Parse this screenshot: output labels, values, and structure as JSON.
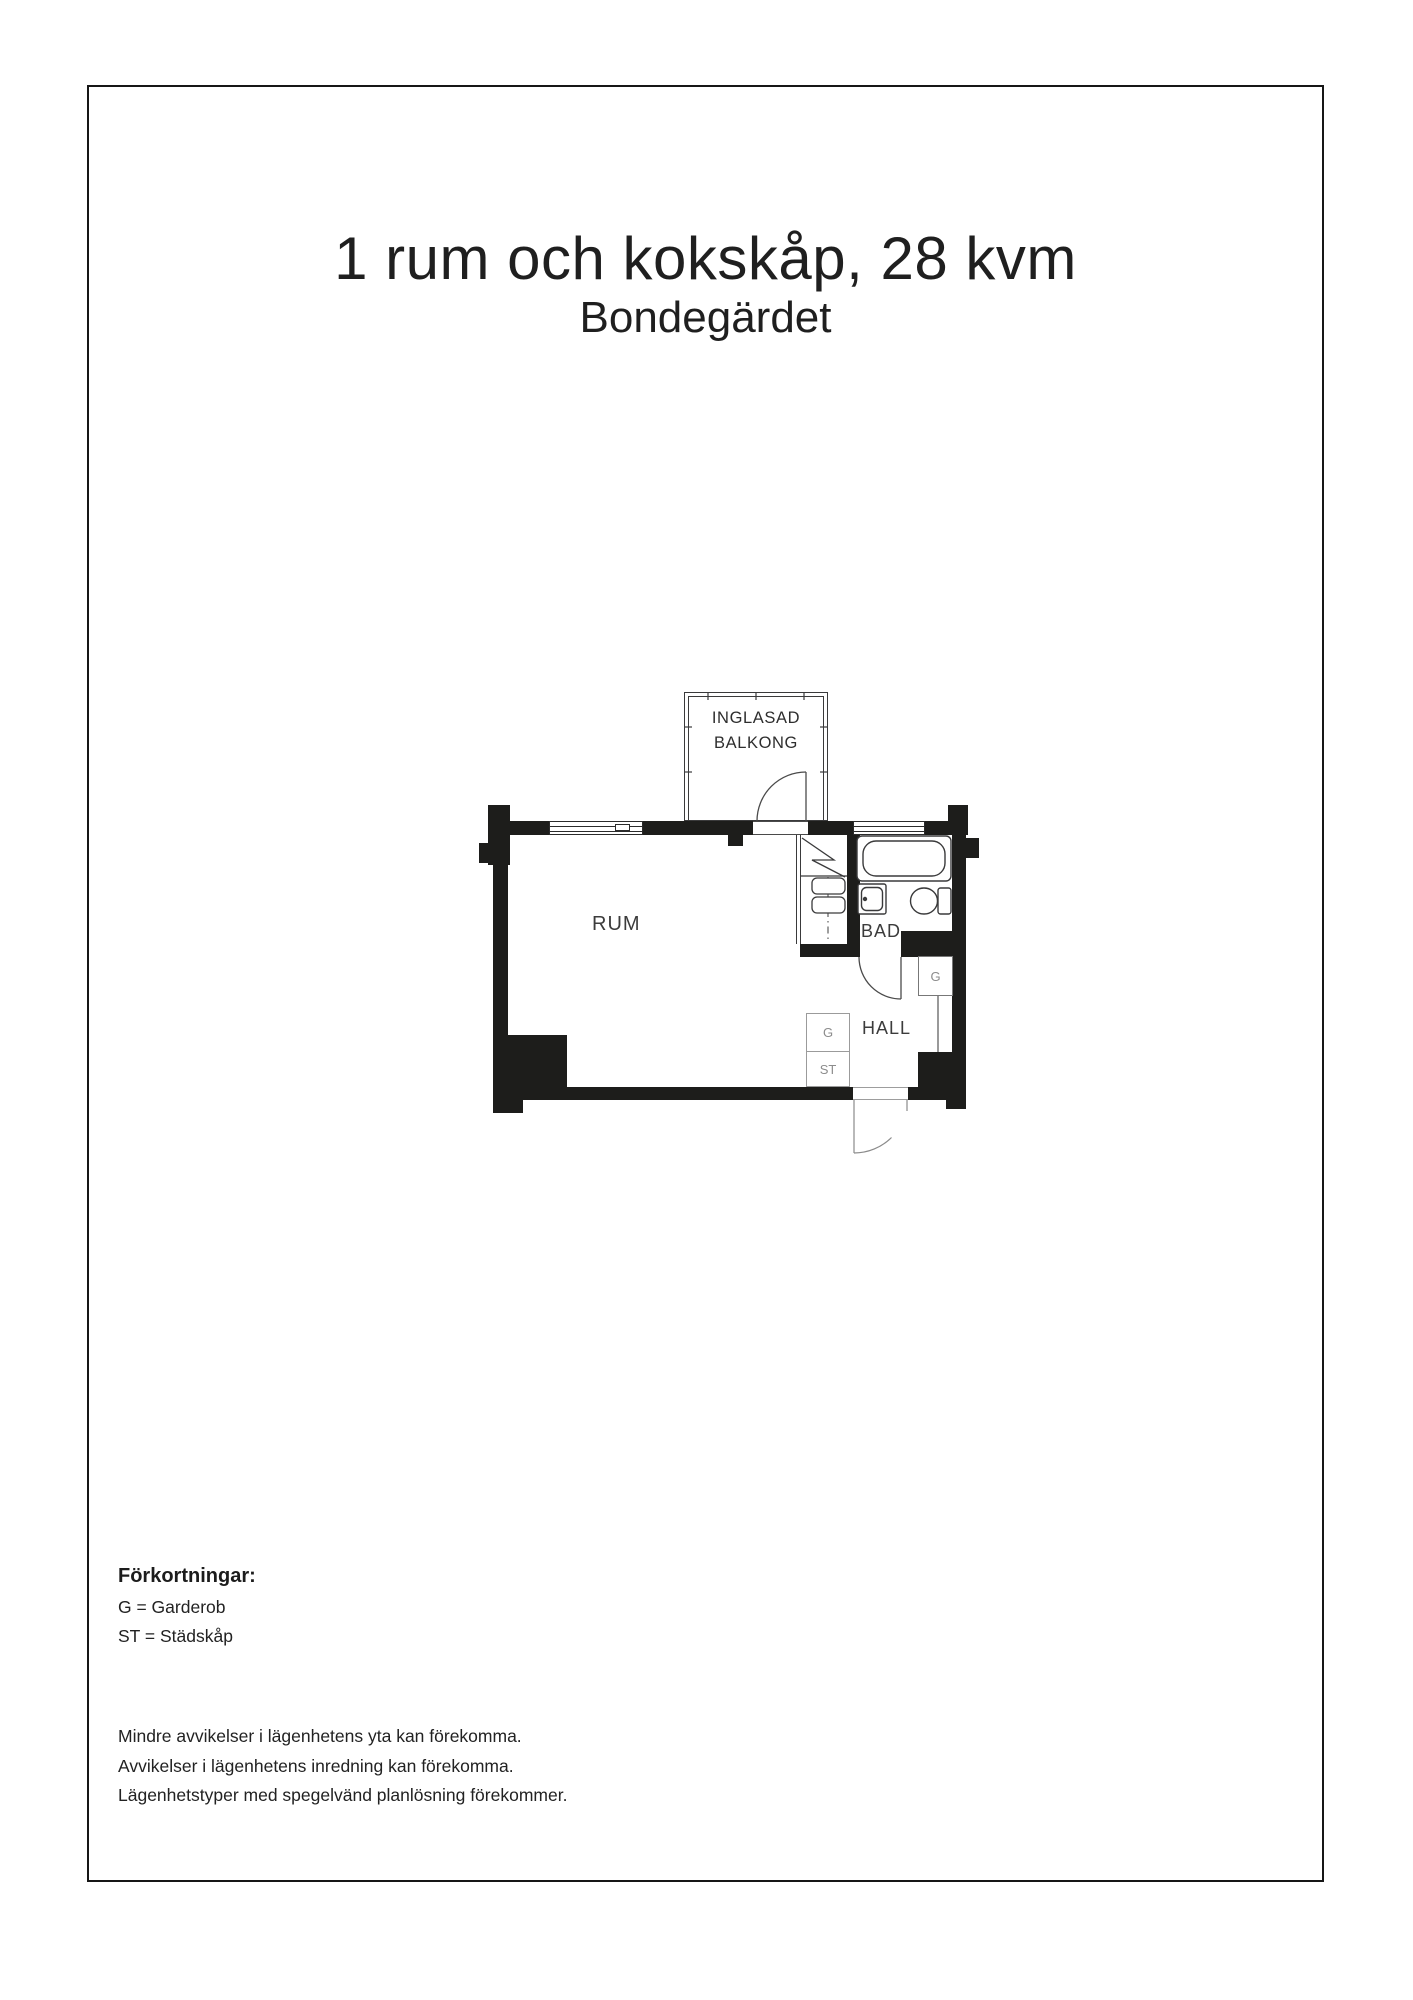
{
  "header": {
    "title": "1 rum och kokskåp, 28 kvm",
    "subtitle": "Bondegärdet"
  },
  "floorplan": {
    "rooms": {
      "rum": "RUM",
      "bad": "BAD",
      "hall": "HALL"
    },
    "balcony": {
      "line1": "INGLASAD",
      "line2": "BALKONG"
    },
    "closets": {
      "garderob": "G",
      "stadskap": "ST"
    },
    "colors": {
      "wall": "#1d1d1b",
      "line": "#3a3a3b",
      "muted_label": "#8c8c8c"
    }
  },
  "abbreviations": {
    "title": "Förkortningar:",
    "items": [
      "G = Garderob",
      "ST = Städskåp"
    ]
  },
  "disclaimer": {
    "lines": [
      "Mindre avvikelser i lägenhetens yta kan förekomma.",
      "Avvikelser i lägenhetens inredning kan förekomma.",
      "Lägenhetstyper med spegelvänd planlösning förekommer."
    ]
  }
}
